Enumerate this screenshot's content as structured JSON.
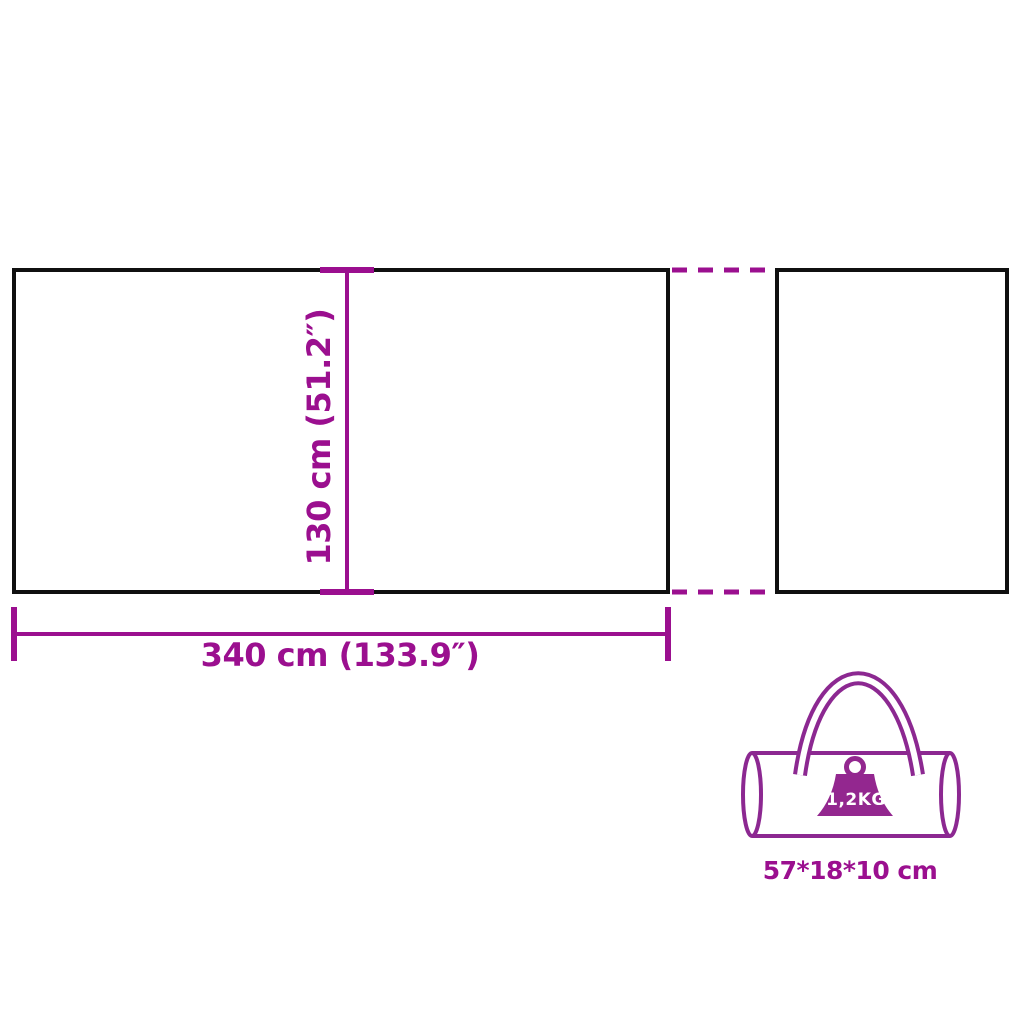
{
  "diagram": {
    "main_panel": {
      "width_label": "340 cm (133.9″)",
      "height_label": "130 cm (51.2″)"
    },
    "carry_bag": {
      "weight_label": "1,2KG",
      "size_label": "57*18*10 cm"
    },
    "colors": {
      "dimension_magenta": "#9B0F8F",
      "panel_outline_black": "#101010",
      "bag_purple": "#8C2891",
      "weight_fill": "#93278F"
    }
  }
}
